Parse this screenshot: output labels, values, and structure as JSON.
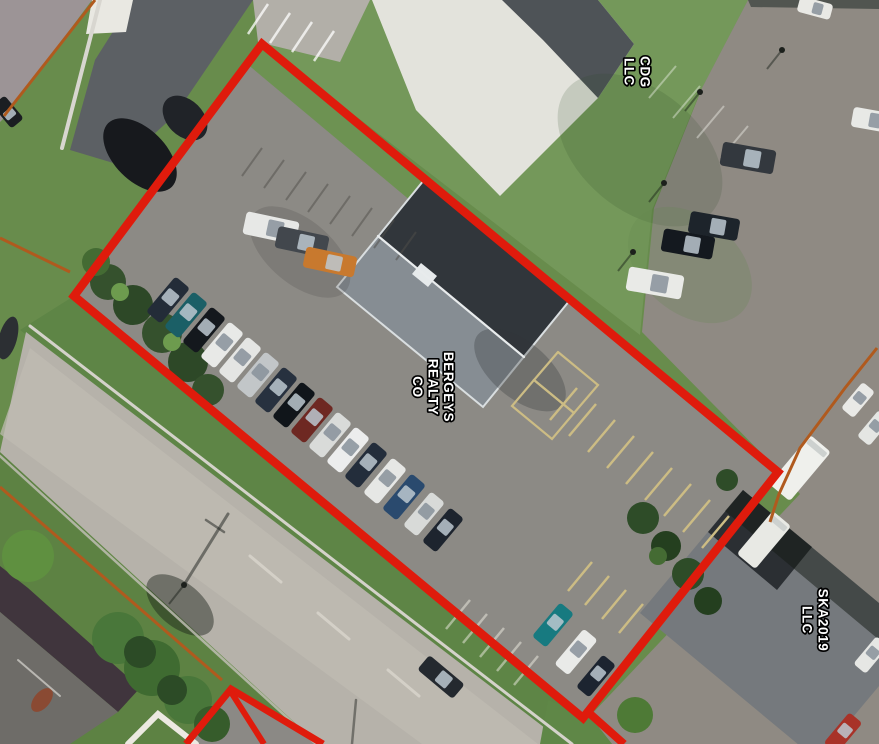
{
  "labels": {
    "cdg": {
      "name": "CDG LLC",
      "lines": [
        "CDG",
        "LLC"
      ]
    },
    "bergeys": {
      "name": "BERGEYS REALTY CO",
      "lines": [
        "BERGEYS",
        "REALTY",
        "CO"
      ]
    },
    "ska": {
      "name": "SKA2019 LLC",
      "lines": [
        "SKA2019",
        "LLC"
      ]
    }
  },
  "annotation_colors": {
    "primary_boundary": "#df1b0c",
    "secondary_boundary": "#b05a1e",
    "label_fill": "#ffffff",
    "label_outline": "#000000"
  },
  "scene": {
    "size": {
      "w": 879,
      "h": 744
    },
    "polys": [
      {
        "n": "lawn-light",
        "p": "340,0 748,0 700,92 652,210 640,335 262,44",
        "f": "#74985a"
      },
      {
        "n": "sw-verge",
        "p": "0,452 316,744 0,744",
        "f": "#5d8243"
      },
      {
        "n": "ne-verge",
        "p": "74,296 583,718 560,744 20,330",
        "f": "#5e8546"
      },
      {
        "n": "nw-street",
        "p": "0,0 92,0 4,118 0,122",
        "f": "#9c9496"
      },
      {
        "n": "alley-pavement",
        "p": "133,0 253,0 175,115 120,165 70,150 95,60",
        "f": "#5c6064"
      },
      {
        "n": "white-roof-block",
        "p": "92,0 133,0 126,32 86,34",
        "f": "#e9e8e2"
      },
      {
        "n": "striped-lot",
        "p": "253,0 370,0 340,62 258,42",
        "f": "#b2afa8"
      },
      {
        "n": "white-pad-roof",
        "p": "372,0 598,0 634,44 598,98 500,196 416,110",
        "f": "#e3e3dc"
      },
      {
        "n": "pad-roof-dark-band",
        "p": "502,0 598,0 634,44 598,98 543,40",
        "f": "#4e5357"
      },
      {
        "n": "east-pavement",
        "p": "748,0 879,0 879,744 612,744 590,716 800,494 776,468 642,332 654,208 702,88",
        "f": "#8f8a83"
      },
      {
        "n": "east-pavement-top-strip",
        "p": "748,0 879,0 879,9 751,7",
        "f": "#515550"
      },
      {
        "n": "parcel-lot",
        "p": "262,44 778,472 583,718 74,296",
        "f": "#8c8a85"
      },
      {
        "n": "parcel-grass-band",
        "p": "262,44 440,192 424,212 246,63",
        "f": "#6d9252"
      },
      {
        "n": "road",
        "p": "26,332 566,744 318,744 0,452",
        "f": "#b6b2aa"
      },
      {
        "n": "road-center-band",
        "p": "30,348 538,744 422,744 0,434",
        "f": "#bfbbb2",
        "o": 0.75
      },
      {
        "n": "c-corner-grass",
        "p": "548,700 590,716 612,744 540,744",
        "f": "#5f8747"
      },
      {
        "n": "small-parcel-pavement",
        "p": "231,690 320,744 188,744",
        "f": "#8b8985"
      },
      {
        "n": "bl-building-roof-band",
        "p": "0,566 28,588 140,688 118,712 0,612",
        "f": "#40353d"
      },
      {
        "n": "bl-building-roof-main",
        "p": "0,612 118,712 70,744 0,744",
        "f": "#6e6c68"
      },
      {
        "n": "bergeys-roof",
        "p": "424,180 570,300 483,407 337,287",
        "f": "#31363b"
      },
      {
        "n": "bergeys-roof-se-slope",
        "p": "378,236 524,357 483,407 337,287",
        "f": "#868d93"
      },
      {
        "n": "bergeys-roof-eaves",
        "p": "424,180 570,300 483,407 337,287",
        "f": "none",
        "s": "#d9dee0",
        "sw": 2
      },
      {
        "n": "bergeys-rooftop-unit",
        "p": "428,287 437,276 421,263 412,274",
        "f": "#e6eaeb"
      },
      {
        "n": "ska-roof",
        "p": "743,490 920,637 817,760 640,613",
        "f": "#75797d"
      },
      {
        "n": "ska-roof-dark-section",
        "p": "743,490 812,547 777,590 708,532",
        "f": "#2b2f33"
      },
      {
        "n": "ska-roof-tree-shadow",
        "p": "743,490 920,637 902,659 725,511",
        "f": "rgba(20,26,20,0.5)"
      }
    ],
    "blobs": [
      {
        "n": "alley-shadow",
        "x": 140,
        "y": 155,
        "rx": 45,
        "ry": 26,
        "a": 45,
        "f": "#17191d"
      },
      {
        "n": "alley-shadow-2",
        "x": 185,
        "y": 118,
        "rx": 26,
        "ry": 18,
        "a": 45,
        "f": "#202328"
      },
      {
        "n": "lawn-shade",
        "x": 640,
        "y": 150,
        "rx": 95,
        "ry": 60,
        "a": 40,
        "f": "rgba(45,75,35,0.16)"
      },
      {
        "n": "lawn-light-patch",
        "x": 690,
        "y": 265,
        "rx": 70,
        "ry": 48,
        "a": 40,
        "f": "rgba(100,135,80,0.25)"
      },
      {
        "n": "lot-wear-patch",
        "x": 300,
        "y": 252,
        "rx": 60,
        "ry": 32,
        "a": 40,
        "f": "rgba(60,58,55,0.18)"
      },
      {
        "n": "building-shadow",
        "x": 520,
        "y": 370,
        "rx": 55,
        "ry": 28,
        "a": 40,
        "f": "rgba(50,52,55,0.3)"
      },
      {
        "n": "road-tree-shadow",
        "x": 180,
        "y": 605,
        "rx": 40,
        "ry": 22,
        "a": 40,
        "f": "rgba(25,30,25,0.45)"
      },
      {
        "n": "chimney",
        "x": 42,
        "y": 700,
        "rx": 8,
        "ry": 14,
        "a": 40,
        "f": "#8a4a33"
      },
      {
        "n": "left-edge-shadow",
        "x": 8,
        "y": 338,
        "rx": 9,
        "ry": 22,
        "a": 15,
        "f": "#2c2f33"
      }
    ],
    "stripes": [
      {
        "n": "striped-lot-stripes",
        "x": 268,
        "y": 4,
        "dx": 22,
        "dy": 9,
        "ex": -20,
        "ey": 30,
        "c": "rgba(255,255,255,0.75)",
        "w": 2.5,
        "count": 4
      },
      {
        "n": "lot-top-stripes",
        "x": 262,
        "y": 148,
        "dx": 22,
        "dy": 12,
        "ex": -20,
        "ey": 28,
        "c": "rgba(80,78,74,0.5)",
        "w": 2,
        "count": 8
      },
      {
        "n": "yellow-stripes-main",
        "x": 577,
        "y": 388,
        "dx": 19,
        "dy": 16,
        "ex": -27,
        "ey": 32,
        "c": "#ccbc84",
        "w": 2.5,
        "count": 9
      },
      {
        "n": "yellow-stripes-south",
        "x": 592,
        "y": 562,
        "dx": 17,
        "dy": 14,
        "ex": -24,
        "ey": 29,
        "c": "#ccbc84",
        "w": 2.5,
        "count": 5
      },
      {
        "n": "white-stripes-c",
        "x": 470,
        "y": 600,
        "dx": 17,
        "dy": 14,
        "ex": -24,
        "ey": 29,
        "c": "rgba(240,238,228,0.5)",
        "w": 2.5,
        "count": 5
      },
      {
        "n": "right-lot-stripes",
        "x": 676,
        "y": 66,
        "dx": 24,
        "dy": 20,
        "ex": -27,
        "ey": 32,
        "c": "rgba(250,250,244,0.4)",
        "w": 2,
        "count": 4
      }
    ],
    "lines": [
      {
        "n": "alley-curb",
        "p": "100,0 62,148",
        "c": "#d8d6d0",
        "w": 4
      },
      {
        "n": "road-curb-ne",
        "p": "30,326 572,744",
        "c": "#d4d2ca",
        "w": 3
      },
      {
        "n": "road-curb-sw",
        "p": "0,456 316,744",
        "c": "#c6c2ba",
        "w": 2.5,
        "o": 0.8
      },
      {
        "n": "road-dash-1",
        "p": "250,556 281,582",
        "c": "#d9d6cd",
        "w": 3,
        "o": 0.8
      },
      {
        "n": "road-dash-2",
        "p": "318,613 349,639",
        "c": "#d9d6cd",
        "w": 3,
        "o": 0.8
      },
      {
        "n": "road-dash-3",
        "p": "388,670 419,696",
        "c": "#d9d6cd",
        "w": 3,
        "o": 0.8
      },
      {
        "n": "bergeys-ridge-line",
        "p": "378,236 524,357",
        "c": "#e8ebec",
        "w": 2.2
      },
      {
        "n": "yellow-box-1",
        "p": "558,352 598,385 574,413 534,380 558,352",
        "c": "#ccbc84",
        "w": 2.2
      },
      {
        "n": "yellow-box-2",
        "p": "534,380 574,413 552,439 512,406 534,380",
        "c": "#ccbc84",
        "w": 2.2
      },
      {
        "n": "bl-white-walk",
        "p": "128,744 158,714 196,744",
        "c": "#ece9e1",
        "w": 6
      },
      {
        "n": "bl-roof-ridge",
        "p": "18,660 60,696",
        "c": "#b9b7b2",
        "w": 2
      },
      {
        "n": "utility-pole-shadow",
        "p": "184,585 228,514",
        "c": "rgba(28,32,28,0.5)",
        "w": 3
      },
      {
        "n": "utility-pole-cross",
        "p": "224,532 206,520",
        "c": "rgba(28,32,28,0.5)",
        "w": 2.5
      },
      {
        "n": "pole-shadow-bottom",
        "p": "356,700 352,744",
        "c": "rgba(28,32,28,0.45)",
        "w": 2.5
      }
    ],
    "trees": [
      [
        28,
        556,
        26,
        "#5f9040"
      ],
      [
        118,
        638,
        26,
        "#49773a"
      ],
      [
        152,
        668,
        28,
        "#3f6b31"
      ],
      [
        188,
        700,
        24,
        "#49773a"
      ],
      [
        212,
        724,
        18,
        "#365c2b"
      ],
      [
        140,
        652,
        16,
        "#2c4b26"
      ],
      [
        172,
        690,
        15,
        "#2c4b26"
      ],
      [
        108,
        282,
        18,
        "#35512d"
      ],
      [
        133,
        305,
        20,
        "#2d4827"
      ],
      [
        162,
        333,
        20,
        "#35512d"
      ],
      [
        188,
        362,
        20,
        "#2d4827"
      ],
      [
        208,
        390,
        16,
        "#35512d"
      ],
      [
        120,
        292,
        9,
        "#6d9b4e"
      ],
      [
        172,
        342,
        9,
        "#6d9b4e"
      ],
      [
        96,
        262,
        14,
        "#446b33"
      ],
      [
        643,
        518,
        16,
        "#2e4c28"
      ],
      [
        666,
        546,
        15,
        "#243f1f"
      ],
      [
        688,
        574,
        16,
        "#2e4c28"
      ],
      [
        708,
        601,
        14,
        "#243f1f"
      ],
      [
        658,
        556,
        9,
        "#446b33"
      ],
      [
        727,
        480,
        11,
        "#2e4c28"
      ],
      [
        635,
        715,
        18,
        "#4e7a36"
      ]
    ],
    "poles": [
      [
        700,
        92
      ],
      [
        664,
        183
      ],
      [
        633,
        252
      ],
      [
        782,
        50
      ],
      [
        184,
        585
      ]
    ],
    "cars": [
      [
        271,
        228,
        54,
        23,
        12,
        "#e7e8e6"
      ],
      [
        302,
        242,
        52,
        22,
        12,
        "#42474d"
      ],
      [
        330,
        262,
        52,
        21,
        12,
        "#c8792e"
      ],
      [
        168,
        300,
        46,
        19,
        -50,
        "#232c38"
      ],
      [
        186,
        315,
        46,
        19,
        -50,
        "#1b5f66"
      ],
      [
        204,
        330,
        46,
        19,
        -50,
        "#14181d"
      ],
      [
        222,
        345,
        46,
        19,
        -50,
        "#e8e9e7"
      ],
      [
        240,
        360,
        46,
        19,
        -50,
        "#e4e5e3"
      ],
      [
        258,
        375,
        46,
        19,
        -50,
        "#c2c6c8"
      ],
      [
        276,
        390,
        46,
        19,
        -50,
        "#27313f"
      ],
      [
        294,
        405,
        46,
        19,
        -50,
        "#10151a"
      ],
      [
        312,
        420,
        46,
        19,
        -50,
        "#6e2822"
      ],
      [
        330,
        435,
        46,
        19,
        -50,
        "#d9dbd9"
      ],
      [
        348,
        450,
        46,
        19,
        -50,
        "#eceded"
      ],
      [
        366,
        465,
        46,
        19,
        -50,
        "#232d3b"
      ],
      [
        385,
        481,
        46,
        19,
        -50,
        "#e6e7e5"
      ],
      [
        404,
        497,
        46,
        19,
        -50,
        "#2a4a6e"
      ],
      [
        424,
        514,
        44,
        18,
        -50,
        "#d8dad8"
      ],
      [
        443,
        530,
        44,
        18,
        -50,
        "#1d242e"
      ],
      [
        553,
        625,
        44,
        18,
        -50,
        "#177a80"
      ],
      [
        576,
        652,
        46,
        18,
        -50,
        "#e9eae8"
      ],
      [
        596,
        676,
        42,
        17,
        -50,
        "#1c2430"
      ],
      [
        655,
        283,
        56,
        24,
        10,
        "#e9eae7"
      ],
      [
        688,
        244,
        52,
        23,
        10,
        "#14191f"
      ],
      [
        714,
        226,
        50,
        22,
        10,
        "#1d242b"
      ],
      [
        748,
        158,
        54,
        24,
        10,
        "#33383e"
      ],
      [
        815,
        8,
        34,
        16,
        15,
        "#e9e9e5"
      ],
      [
        872,
        120,
        40,
        20,
        10,
        "#e8e9e6"
      ],
      [
        858,
        400,
        34,
        16,
        -50,
        "#e9e9e6"
      ],
      [
        874,
        428,
        34,
        16,
        -50,
        "#e4e6e3"
      ],
      [
        800,
        468,
        64,
        27,
        -50,
        "#eff0ec",
        "t"
      ],
      [
        764,
        540,
        56,
        24,
        -50,
        "#e8e9e4",
        "t"
      ],
      [
        843,
        733,
        40,
        17,
        -50,
        "#a83228"
      ],
      [
        871,
        655,
        36,
        16,
        -50,
        "#e6e7e4"
      ],
      [
        441,
        677,
        46,
        19,
        40,
        "#24292f"
      ],
      [
        8,
        112,
        30,
        16,
        50,
        "#1b1e22"
      ]
    ],
    "bounds": [
      {
        "n": "adjacent-boundary-nw",
        "p": "95,0 4,116",
        "col": "secondary_boundary",
        "w": 3
      },
      {
        "n": "adjacent-boundary-w",
        "p": "0,238 70,272",
        "col": "secondary_boundary",
        "w": 3
      },
      {
        "n": "adjacent-boundary-sw",
        "p": "0,487 222,680",
        "col": "secondary_boundary",
        "w": 3
      },
      {
        "n": "adjacent-boundary-e",
        "p": "877,348 845,388 800,448 779,494 770,522",
        "col": "secondary_boundary",
        "w": 3
      },
      {
        "n": "primary-parcel-boundary",
        "p": "262,44 778,472 583,718 74,296",
        "col": "primary_boundary",
        "w": 8.5,
        "closed": true
      },
      {
        "n": "primary-boundary-extension",
        "p": "588,712 624,744",
        "col": "primary_boundary",
        "w": 8
      },
      {
        "n": "secondary-parcel-boundary",
        "p": "186,744 231,689 323,744",
        "col": "primary_boundary",
        "w": 7
      },
      {
        "n": "secondary-parcel-divider",
        "p": "231,692 264,744",
        "col": "primary_boundary",
        "w": 6
      }
    ]
  }
}
